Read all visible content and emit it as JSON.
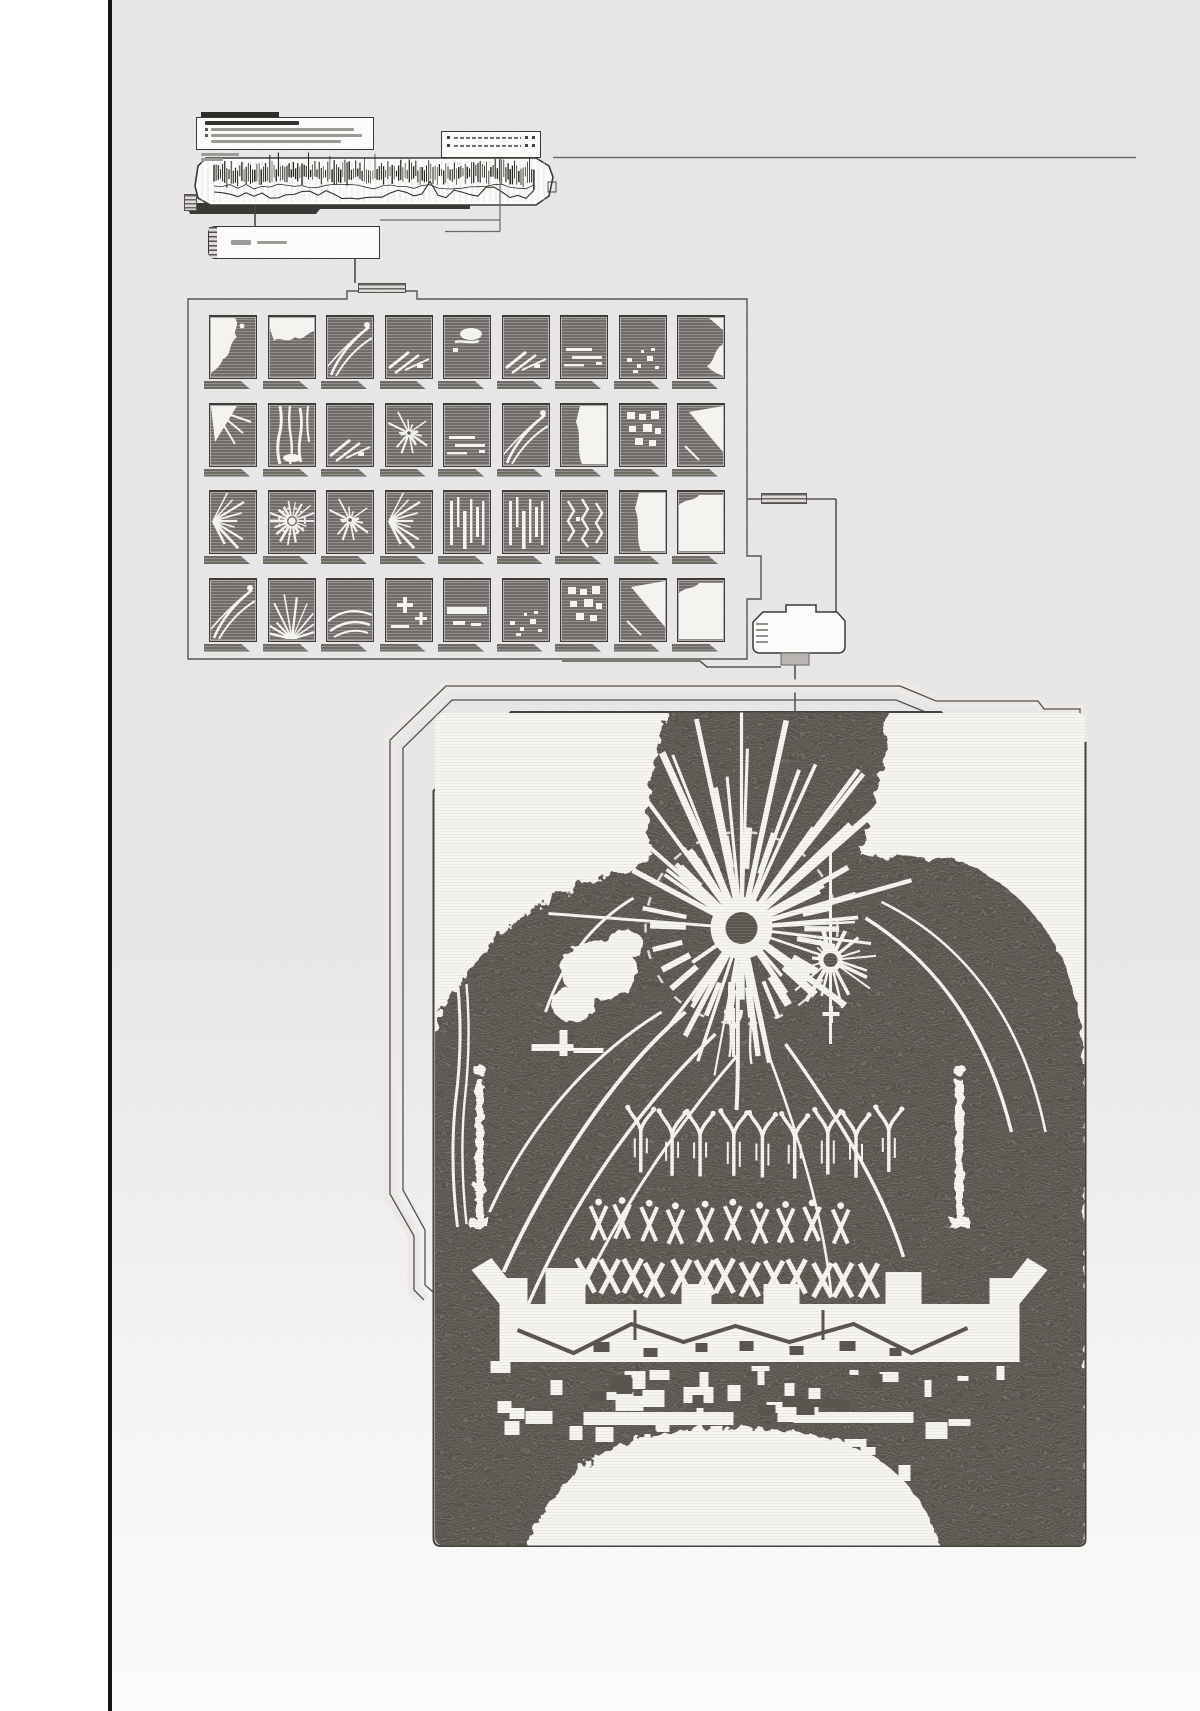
{
  "colors": {
    "ink": "#3c3a37",
    "line": "#55514d",
    "halftone_dark": "#59554f",
    "halftone_light": "#756f68",
    "panel_fill": "#f3f2ef",
    "art_white": "#f6f5f2",
    "cell_white": "#f4f3f0",
    "rule_black": "#151513",
    "bg_checker": "#e6e6e6"
  },
  "icons": {
    "left_rule": "page-margin-rule",
    "info_card": "annotation-card",
    "signal_strip": "signal-waveform-strip",
    "list_card": "legend-list-card",
    "label_card": "caption-label-card",
    "thumb_grid": "event-thumbnail-grid",
    "link_box": "connector-tab-box",
    "artwork": "halftone-collision-artwork"
  },
  "signal_strip": {
    "tick_count": 150,
    "seed": 11,
    "x0": 214,
    "x1": 536,
    "mid_y": 174
  },
  "info_card": {
    "text_lines": 3
  },
  "list_card": {
    "rows": 2
  },
  "thumb_grid": {
    "rows": 4,
    "cols": 9,
    "x0": 209,
    "y0": 315,
    "pitch_x": 58.5,
    "pitch_y": 87.5,
    "cell_w": 48,
    "cell_h": 64,
    "pattern_map": [
      [
        "cloud-left",
        "cloud-top",
        "tracks",
        "streaks-diag",
        "blob-center",
        "streaks-diag",
        "streaks-horiz",
        "specks",
        "corner-blob"
      ],
      [
        "wedge-rays",
        "jets",
        "streaks-diag",
        "starburst",
        "streaks-horiz",
        "tracks",
        "white-right",
        "blocks",
        "wedge-big"
      ],
      [
        "radial-left",
        "radial-ring",
        "starburst",
        "radial-left",
        "vert-stripes",
        "vert-stripes",
        "zigzag",
        "white-right",
        "mostly-white"
      ],
      [
        "tracks",
        "fan-bottom",
        "arcs",
        "cross",
        "band",
        "specks",
        "blocks",
        "wedge-big",
        "mostly-white"
      ]
    ]
  },
  "artwork": {
    "burst_main": {
      "cx": 308,
      "cy": 216,
      "rays": 40,
      "up_rays": 9,
      "ring_spokes": 26,
      "dot_r": 16,
      "disc_r": 31,
      "ray_min": 55,
      "ray_max": 150,
      "up_len": 218,
      "seed": 5
    },
    "burst_side": {
      "cx": 397,
      "cy": 248,
      "rays": 18,
      "dot_r": 7,
      "disc_r": 12,
      "ray_min": 10,
      "ray_max": 52,
      "seed": 9
    },
    "arm_row": {
      "count": 9,
      "x0": 206,
      "pitch": 31,
      "y": 398,
      "seed": 3
    },
    "x_row": {
      "count": 10,
      "x0": 163,
      "pitch": 27,
      "y": 489,
      "seed": 4
    },
    "xx_row": {
      "count": 13,
      "x0": 152,
      "pitch": 23.5,
      "y": 549,
      "seed": 6
    },
    "debris": {
      "count": 48,
      "dark_count": 10,
      "seed": 8
    }
  }
}
